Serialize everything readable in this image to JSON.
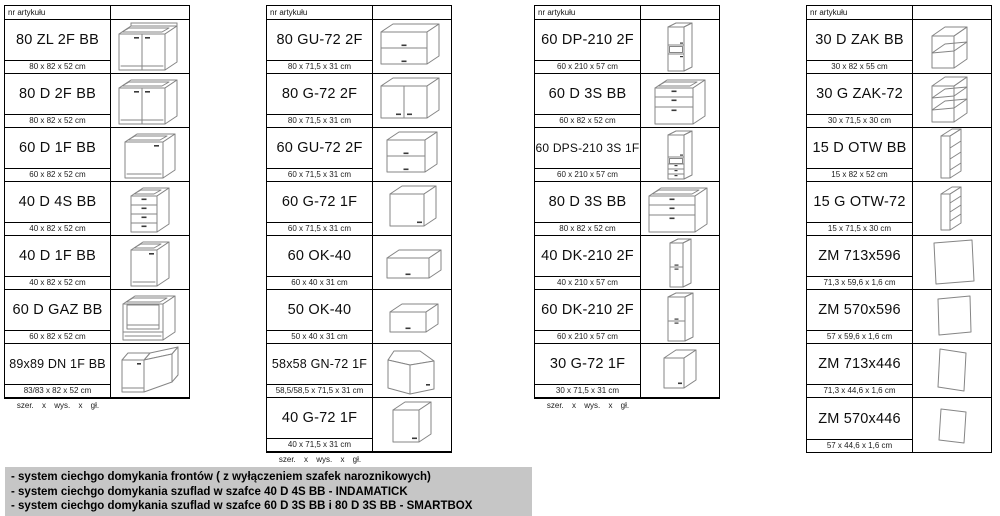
{
  "header_label": "nr artykułu",
  "footer_label": "szer. x wys. x gł.",
  "colors": {
    "table_border": "#000000",
    "drawing_stroke": "#858585",
    "handle": "#3a3a3a",
    "notes_background": "#c6c6c6"
  },
  "tables": [
    {
      "title": "base cabinets",
      "footer": "szer. x wys. x gł.",
      "rows": [
        {
          "code": "80 ZL 2F BB",
          "dims": "80 x 82 x 52 cm",
          "icon": "base-sink-2f"
        },
        {
          "code": "80 D 2F BB",
          "dims": "80 x 82 x 52 cm",
          "icon": "base-2f"
        },
        {
          "code": "60 D 1F BB",
          "dims": "60 x 82 x 52 cm",
          "icon": "base-1f-60"
        },
        {
          "code": "40 D 4S BB",
          "dims": "40 x 82 x 52 cm",
          "icon": "base-4s"
        },
        {
          "code": "40 D 1F BB",
          "dims": "40 x 82 x 52 cm",
          "icon": "base-1f-40"
        },
        {
          "code": "60 D GAZ BB",
          "dims": "60 x 82 x 52 cm",
          "icon": "base-gaz"
        },
        {
          "code": "89x89 DN 1F BB",
          "dims": "83/83 x 82 x 52 cm",
          "icon": "base-corner"
        }
      ]
    },
    {
      "title": "wall cabinets",
      "footer": "szer. x wys. x gł.",
      "rows": [
        {
          "code": "80 GU-72 2F",
          "dims": "80 x 71,5 x 31 cm",
          "icon": "wall-gu-80"
        },
        {
          "code": "80 G-72 2F",
          "dims": "80 x 71,5 x 31 cm",
          "icon": "wall-2f-80"
        },
        {
          "code": "60 GU-72 2F",
          "dims": "60 x 71,5 x 31 cm",
          "icon": "wall-gu-60"
        },
        {
          "code": "60 G-72 1F",
          "dims": "60 x 71,5 x 31 cm",
          "icon": "wall-1f-60"
        },
        {
          "code": "60 OK-40",
          "dims": "60 x 40 x 31 cm",
          "icon": "wall-ok-60"
        },
        {
          "code": "50 OK-40",
          "dims": "50 x 40 x 31 cm",
          "icon": "wall-ok-50"
        },
        {
          "code": "58x58 GN-72 1F",
          "dims": "58,5/58,5 x 71,5 x 31 cm",
          "icon": "wall-corner"
        },
        {
          "code": "40 G-72 1F",
          "dims": "40 x 71,5 x 31 cm",
          "icon": "wall-1f-40"
        }
      ]
    },
    {
      "title": "tall and drawer cabinets",
      "footer": "szer. x wys. x gł.",
      "rows": [
        {
          "code": "60 DP-210 2F",
          "dims": "60 x 210 x 57 cm",
          "icon": "tall-dp"
        },
        {
          "code": "60 D 3S BB",
          "dims": "60 x 82 x 52 cm",
          "icon": "base-3s-60"
        },
        {
          "code": "60 DPS-210 3S 1F",
          "dims": "60 x 210 x 57 cm",
          "icon": "tall-dps"
        },
        {
          "code": "80 D 3S BB",
          "dims": "80 x 82 x 52 cm",
          "icon": "base-3s-80"
        },
        {
          "code": "40 DK-210 2F",
          "dims": "40 x 210 x 57 cm",
          "icon": "tall-dk-40"
        },
        {
          "code": "60 DK-210 2F",
          "dims": "60 x 210 x 57 cm",
          "icon": "tall-dk-60"
        },
        {
          "code": "30 G-72 1F",
          "dims": "30 x 71,5 x 31 cm",
          "icon": "wall-1f-30"
        }
      ]
    },
    {
      "title": "open shelves and panels",
      "footer": "",
      "rows": [
        {
          "code": "30 D ZAK BB",
          "dims": "30 x 82 x 55 cm",
          "icon": "zak-d"
        },
        {
          "code": "30 G ZAK-72",
          "dims": "30 x 71,5 x 30 cm",
          "icon": "zak-g"
        },
        {
          "code": "15 D OTW BB",
          "dims": "15 x 82 x 52 cm",
          "icon": "otw-d"
        },
        {
          "code": "15 G OTW-72",
          "dims": "15 x 71,5 x 30 cm",
          "icon": "otw-g"
        },
        {
          "code": "ZM 713x596",
          "dims": "71,3 x 59,6 x 1,6 cm",
          "icon": "panel-713x596"
        },
        {
          "code": "ZM 570x596",
          "dims": "57 x 59,6 x 1,6 cm",
          "icon": "panel-570x596"
        },
        {
          "code": "ZM 713x446",
          "dims": "71,3 x 44,6 x 1,6 cm",
          "icon": "panel-713x446"
        },
        {
          "code": "ZM 570x446",
          "dims": "57 x 44,6 x 1,6 cm",
          "icon": "panel-570x446"
        }
      ]
    }
  ],
  "notes": {
    "lines": [
      "- system ciechgo domykania frontów ( z wyłączeniem szafek naroznikowych)",
      "- system ciechgo domykania szuflad w szafce 40 D 4S BB - INDAMATICK",
      "- system ciechgo domykania szuflad w szafce 60 D 3S BB i 80 D 3S BB - SMARTBOX"
    ]
  }
}
